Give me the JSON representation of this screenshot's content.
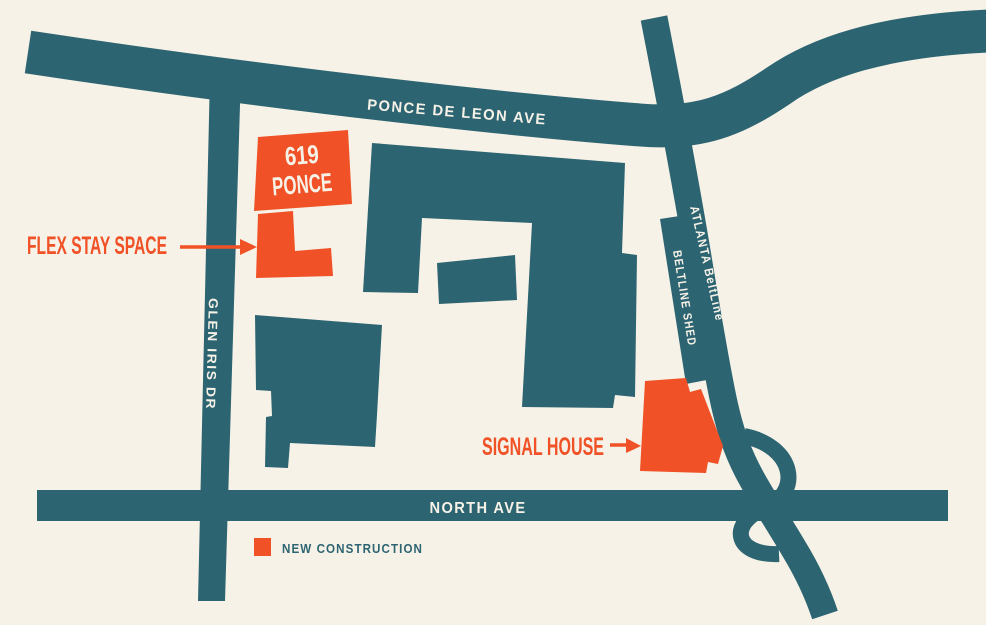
{
  "colors": {
    "teal": "#2D6472",
    "orange": "#F05126",
    "background": "#F6F2E7",
    "road_label": "#F6F2E7"
  },
  "roads": {
    "ponce": {
      "label": "PONCE DE LEON AVE"
    },
    "north": {
      "label": "NORTH AVE"
    },
    "glen_iris": {
      "label": "GLEN IRIS DR"
    },
    "beltline": {
      "label": "ATLANTA BeltLine"
    },
    "beltline_shed": {
      "label": "BELTLINE SHED"
    }
  },
  "buildings": {
    "ponce619": {
      "label_line1": "619",
      "label_line2": "PONCE",
      "type": "new construction"
    },
    "flex_stay_space": {
      "label": "FLEX STAY SPACE",
      "type": "new construction"
    },
    "signal_house": {
      "label": "SIGNAL HOUSE",
      "type": "new construction"
    }
  },
  "legend": {
    "items": [
      {
        "swatch_color": "#F05126",
        "label": "NEW CONSTRUCTION"
      }
    ]
  }
}
